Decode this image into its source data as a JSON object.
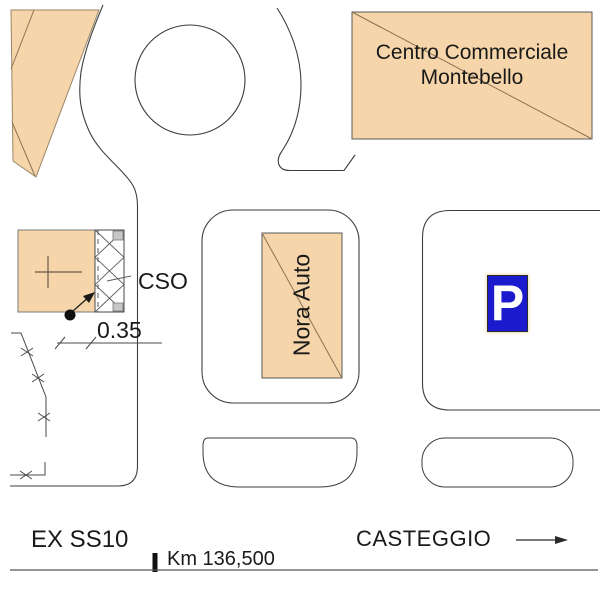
{
  "map": {
    "areas": {
      "centro_commerciale": {
        "label_line1": "Centro Commerciale",
        "label_line2": "Montebello"
      },
      "nora_auto": {
        "label": "Nora Auto"
      },
      "cso_building": {
        "label": "CSO"
      },
      "parking_sign": {
        "symbol": "P"
      }
    },
    "annotations": {
      "dimension_value": "0.35",
      "road_name": "EX SS10",
      "km_marker": "Km 136,500",
      "direction_label": "CASTEGGIO"
    },
    "colors": {
      "building_fill": "#f5d5a9",
      "building_diagonal": "#8c7355",
      "line": "#3d3d3d",
      "parking_blue": "#1b1bcd",
      "hatch_marker_gray": "#c6c6c6"
    }
  }
}
